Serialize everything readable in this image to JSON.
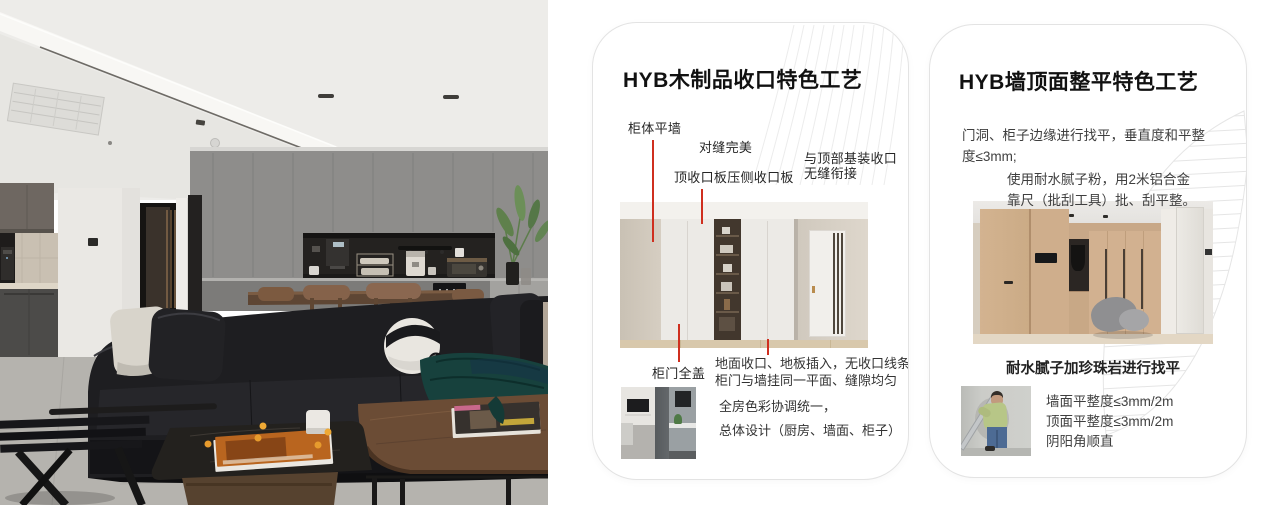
{
  "colors": {
    "accent_red": "#cf2f1f",
    "card_border": "#e3e3e3",
    "title_text": "#111111",
    "body_text": "#3f3f3f"
  },
  "card1": {
    "title": "HYB木制品收口特色工艺",
    "callout_wall_flush": "柜体平墙",
    "callout_seam_perfect": "对缝完美",
    "callout_top_panel": "顶收口板压侧收口板",
    "callout_ceiling_line1": "与顶部基装收口",
    "callout_ceiling_line2": "无缝衔接",
    "callout_full_cover": "柜门全盖",
    "note_line1": "地面收口、地板插入，无收口线条",
    "note_line2": "柜门与墙挂同一平面、缝隙均匀",
    "footer_line1": "全房色彩协调统一，",
    "footer_line2": "总体设计（厨房、墙面、柜子）"
  },
  "card2": {
    "title": "HYB墙顶面整平特色工艺",
    "para1": "门洞、柜子边缘进行找平，垂直度和平整度≤3mm;",
    "para2_line1": "使用耐水腻子粉，用2米铝合金",
    "para2_line2": "靠尺（批刮工具）批、刮平整。",
    "caption": "耐水腻子加珍珠岩进行找平",
    "item1": "墙面平整度≤3mm/2m",
    "item2": "顶面平整度≤3mm/2m",
    "item3": "阴阳角顺直"
  }
}
